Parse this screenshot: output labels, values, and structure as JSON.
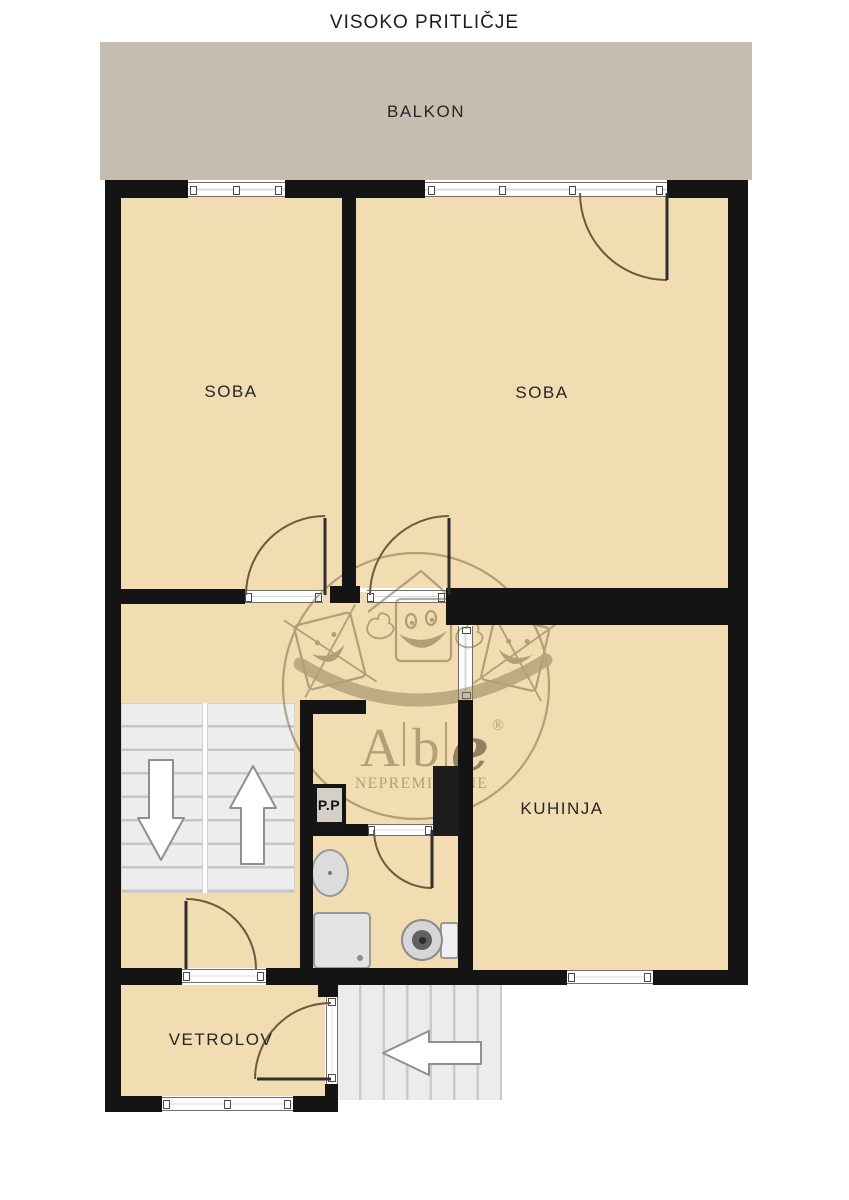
{
  "title": "VISOKO PRITLIČJE",
  "rooms": {
    "balkon": "BALKON",
    "soba_left": "SOBA",
    "soba_right": "SOBA",
    "kuhinja": "KUHINJA",
    "vetrolov": "VETROLOV",
    "pp": "P.P"
  },
  "watermark": {
    "letter_a": "A",
    "letter_b": "b",
    "letter_e": "e",
    "registered": "®",
    "subtitle": "NEPREMICNINE"
  },
  "colors": {
    "floor": "#f2ddb2",
    "balcony": "#c6bdb1",
    "wall": "#141414",
    "stairs": "#ededed",
    "watermark_brown": "#7e6c49",
    "label_text": "#262626"
  }
}
